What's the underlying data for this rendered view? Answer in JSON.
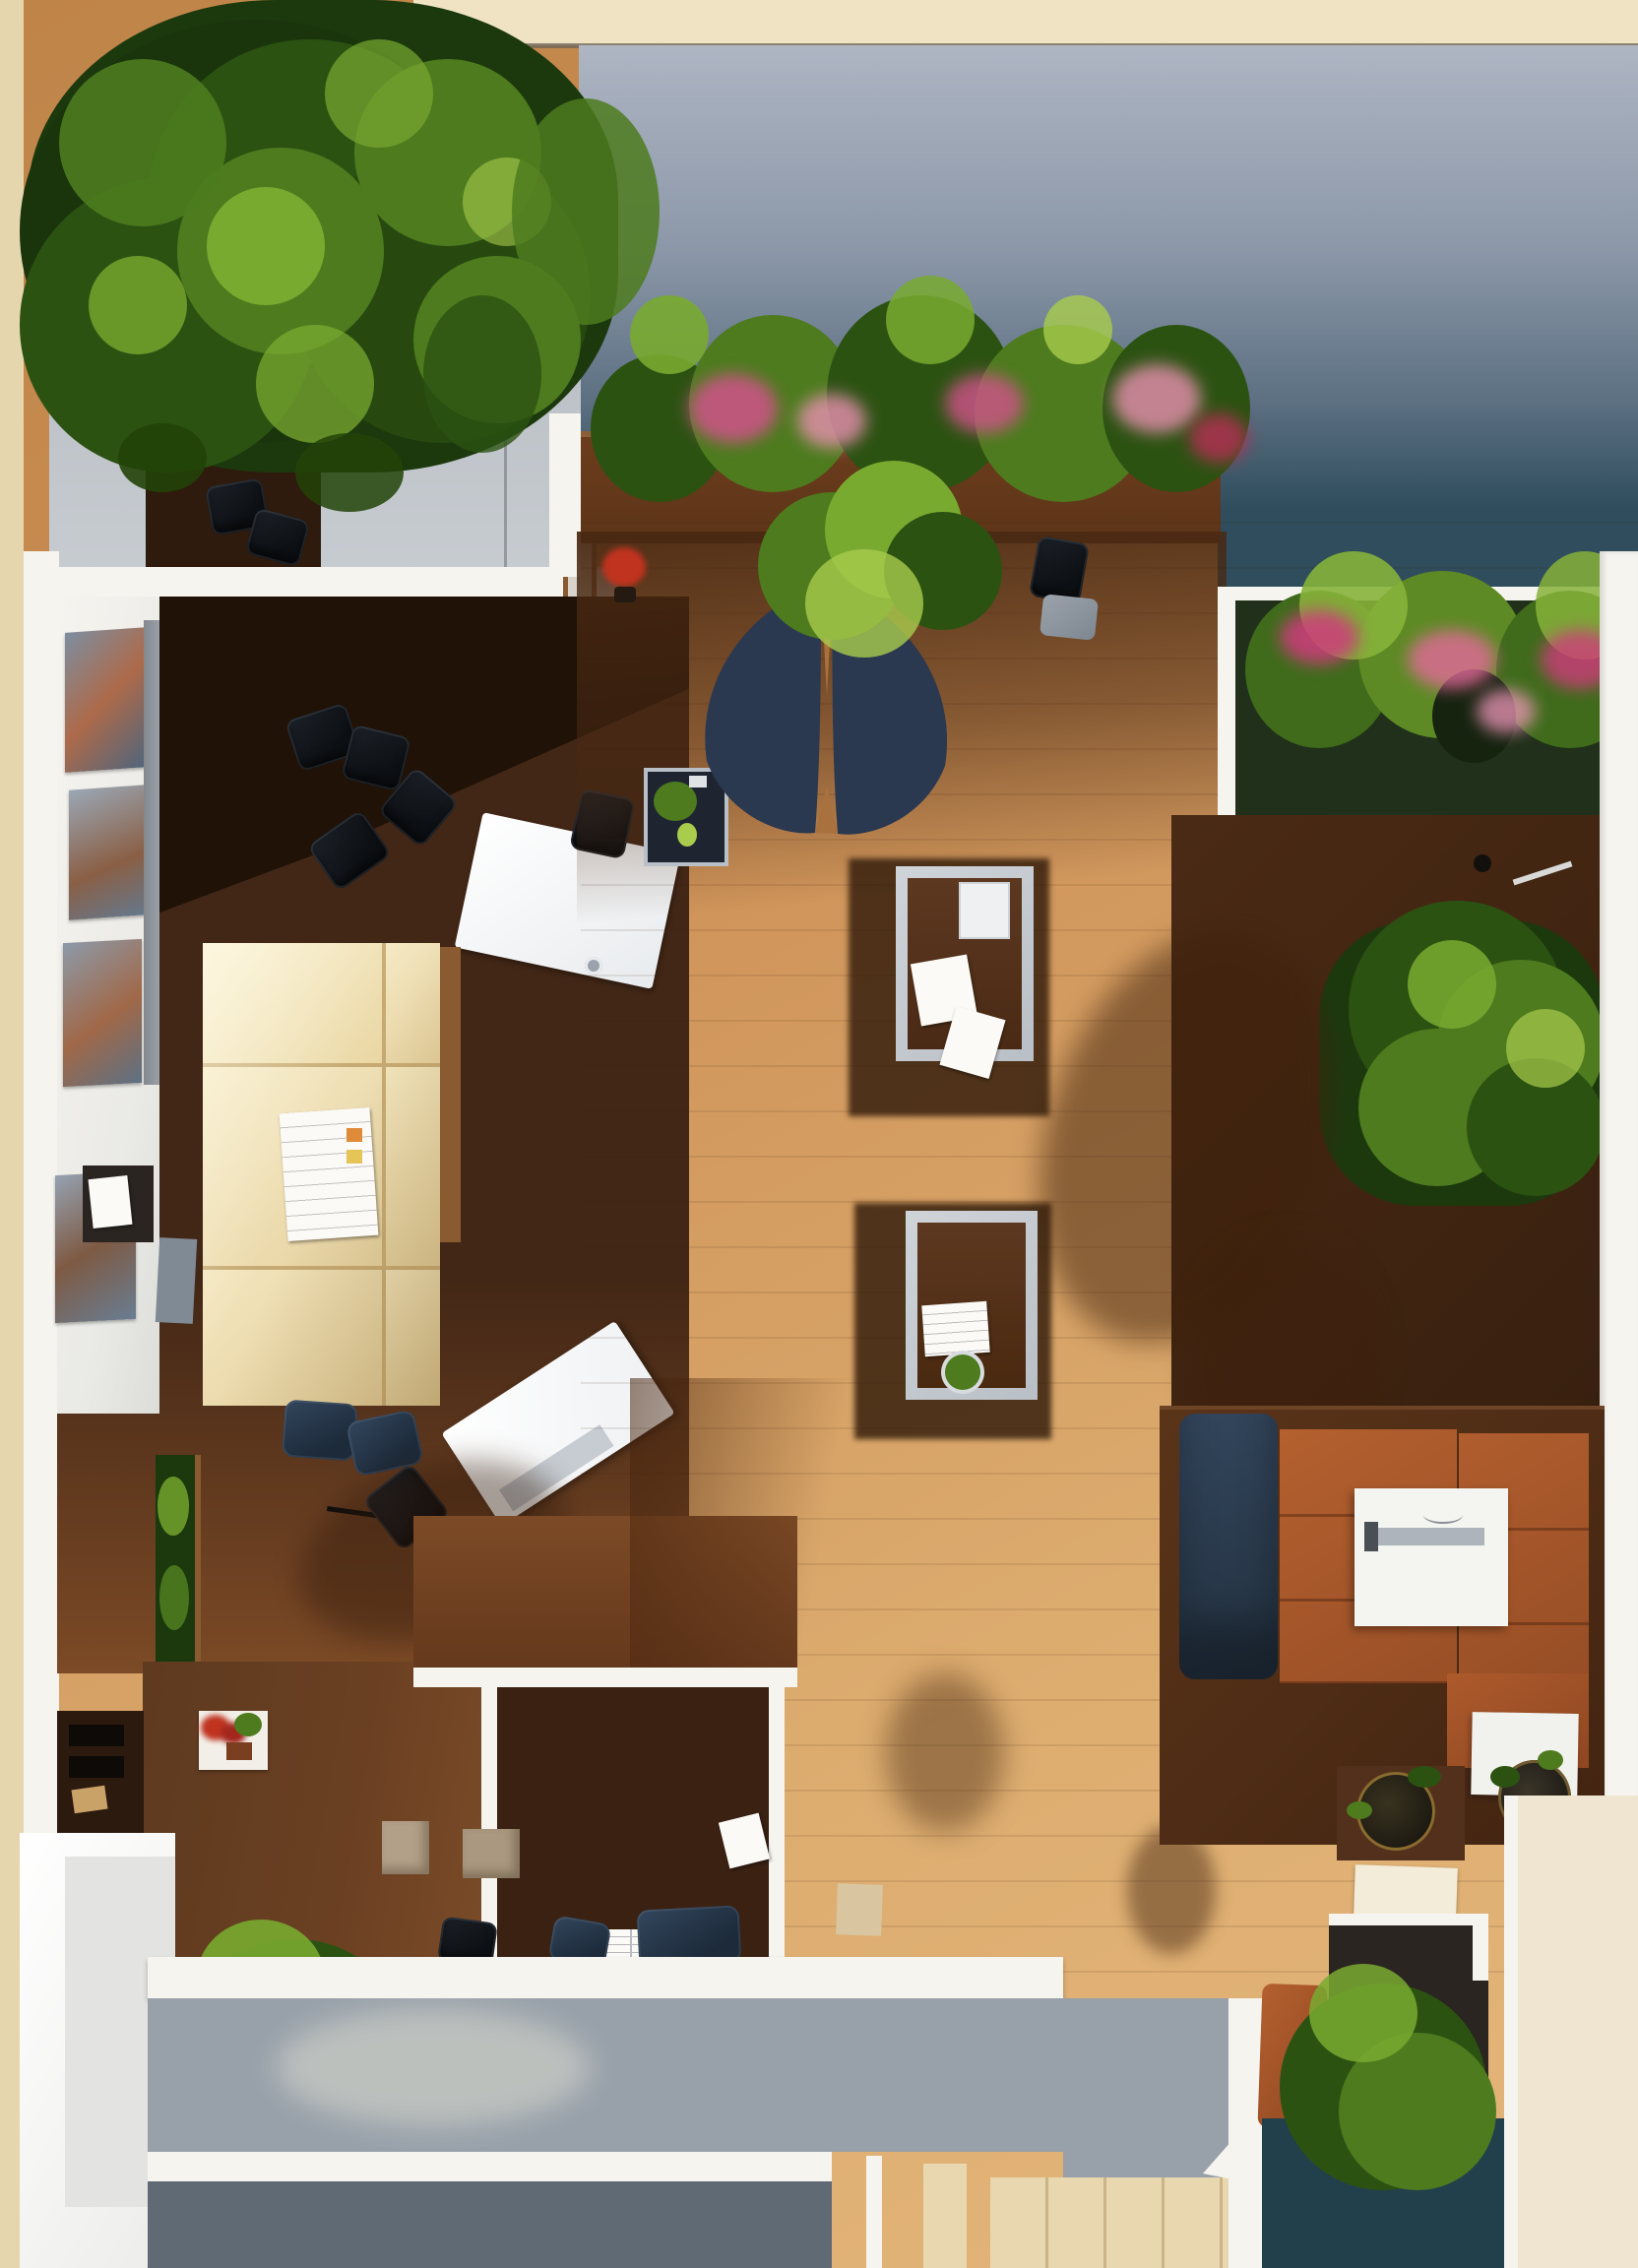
{
  "meta": {
    "title": "Top-down 3D rendering of an office lounge interior with courtyard planters, trees, desks, sectional sofas and deck",
    "view": "aerial / plan view",
    "text_content": "none visible"
  },
  "palette": {
    "cream-edge": "#e6d6ae",
    "khaki": "#7d7355",
    "top-band": "#efe3c3",
    "band-line": "#6f685a",
    "wall-top": "#aeb5c3",
    "wall-mid": "#8b97a8",
    "wall-low": "#5c7082",
    "teal": "#2f4d5c",
    "teal-deep": "#223f4c",
    "white": "#f6f4ef",
    "white-soft": "#e9e9e5",
    "gray-panel": "#b7bcc2",
    "gray-panel-dark": "#9aa0a7",
    "tan": "#cd9056",
    "tan-light": "#ddad70",
    "mid-wood": "#7c4a26",
    "deck-wood": "#6b4022",
    "dark-wood": "#432716",
    "darker-wood": "#2e1b0d",
    "umbra": "#1d1006",
    "counter-wood": "#5d3418",
    "counter-rim": "#8a6038",
    "walnut": "#55321c",
    "silver": "#c7cdd3",
    "navy-planter": "#2a3850",
    "navy-cushion": "#2d3f54",
    "navy-dark": "#1d2b3c",
    "black-chair": "#15181d",
    "rust": "#ac592c",
    "rust-dark": "#8d4521",
    "cream-sofa": "#f2e5bc",
    "sofa-seam": "#c7aa73",
    "wood-edge": "#8a5a30",
    "green-deep": "#1c390e",
    "green-dark": "#2c5212",
    "green-mid": "#4d7b1e",
    "green-bright": "#79aa30",
    "green-lime": "#a9cc4c",
    "pink": "#d2528c",
    "pink-light": "#e990b1",
    "crimson": "#b03053",
    "red": "#c0331f",
    "charcoal": "#2a2521",
    "beige": "#e9d7b0",
    "beige-dark": "#cbb488",
    "gray-deck": "#98a1aa",
    "gray-deck-dark": "#5f6a75",
    "paper": "#fbfaf6",
    "taupe": "#b3a089",
    "chrome": "#9aa2ab"
  },
  "scene": {
    "regions": [
      {
        "name": "courtyard-wall",
        "palette": "wall-mid"
      },
      {
        "name": "courtyard-teal-floor",
        "palette": "teal"
      },
      {
        "name": "top-cream-band",
        "palette": "top-band"
      },
      {
        "name": "partition-panels",
        "palette": "gray-panel"
      },
      {
        "name": "left-office-floor",
        "palette": "dark-wood"
      },
      {
        "name": "open-lounge-floor",
        "palette": "tan"
      },
      {
        "name": "planter-counter",
        "palette": "counter-wood"
      },
      {
        "name": "right-flower-planter-frame",
        "palette": "white"
      },
      {
        "name": "right-dark-floor",
        "palette": "dark-wood"
      },
      {
        "name": "bottom-deck-planks",
        "palette": "deck-wood"
      },
      {
        "name": "enclosed-office-floor",
        "palette": "dark-wood"
      },
      {
        "name": "bar-counter-deck",
        "palette": "gray-deck"
      },
      {
        "name": "bottom-right-teal-pool",
        "palette": "teal-deep"
      },
      {
        "name": "right-white-wall",
        "palette": "white"
      },
      {
        "name": "bottom-right-cream-wall",
        "palette": "beige"
      }
    ],
    "plants": [
      {
        "name": "large-tree-canopy-top-left",
        "palette": "green-dark"
      },
      {
        "name": "flowering-hedge-top",
        "palette": "green-mid",
        "flowers": [
          "pink",
          "pink-light",
          "crimson"
        ]
      },
      {
        "name": "right-flower-planter-shrubs",
        "palette": "green-mid",
        "flowers": [
          "pink",
          "crimson"
        ]
      },
      {
        "name": "navy-wing-planter-shrub",
        "palette": "green-bright"
      },
      {
        "name": "right-potted-tree",
        "palette": "green-dark"
      },
      {
        "name": "bottom-left-shrub",
        "palette": "green-mid"
      },
      {
        "name": "bottom-right-shrub",
        "palette": "green-mid"
      },
      {
        "name": "red-flower-pot",
        "palette": "red"
      },
      {
        "name": "wall-planter-strip",
        "palette": "green-dark"
      },
      {
        "name": "flower-box-red",
        "palette": "red"
      },
      {
        "name": "basket-plants",
        "palette": "green-dark"
      }
    ],
    "furniture": [
      {
        "name": "cream-sectional-sofa",
        "palette": "cream-sofa",
        "cushions": 6
      },
      {
        "name": "white-desk-upper",
        "palette": "paper"
      },
      {
        "name": "white-desk-tilted",
        "palette": "paper"
      },
      {
        "name": "black-office-chairs",
        "palette": "black-chair",
        "count": 10
      },
      {
        "name": "coffee-table-upper",
        "palette": "walnut",
        "frame": "silver"
      },
      {
        "name": "coffee-table-lower",
        "palette": "walnut",
        "frame": "silver"
      },
      {
        "name": "sofa-platform",
        "palette": "walnut"
      },
      {
        "name": "navy-sofa-cushion",
        "palette": "navy-cushion"
      },
      {
        "name": "rust-sofa-cushions",
        "palette": "rust"
      },
      {
        "name": "white-square-table",
        "palette": "white"
      },
      {
        "name": "small-white-side-table",
        "palette": "white"
      },
      {
        "name": "display-side-table",
        "palette": "navy-planter"
      },
      {
        "name": "gray-ottoman",
        "palette": "gray-panel-dark"
      },
      {
        "name": "wall-art-frames",
        "count": 4
      },
      {
        "name": "file-cabinet",
        "palette": "charcoal"
      },
      {
        "name": "shelving-unit",
        "palette": "darker-wood"
      },
      {
        "name": "charcoal-cabinet",
        "palette": "charcoal"
      },
      {
        "name": "rust-lounge-chair",
        "palette": "rust"
      },
      {
        "name": "taupe-stools",
        "palette": "taupe",
        "count": 2
      },
      {
        "name": "white-cabinet-boxes",
        "palette": "white",
        "count": 2
      },
      {
        "name": "beige-cabinet-front",
        "palette": "beige"
      }
    ]
  }
}
